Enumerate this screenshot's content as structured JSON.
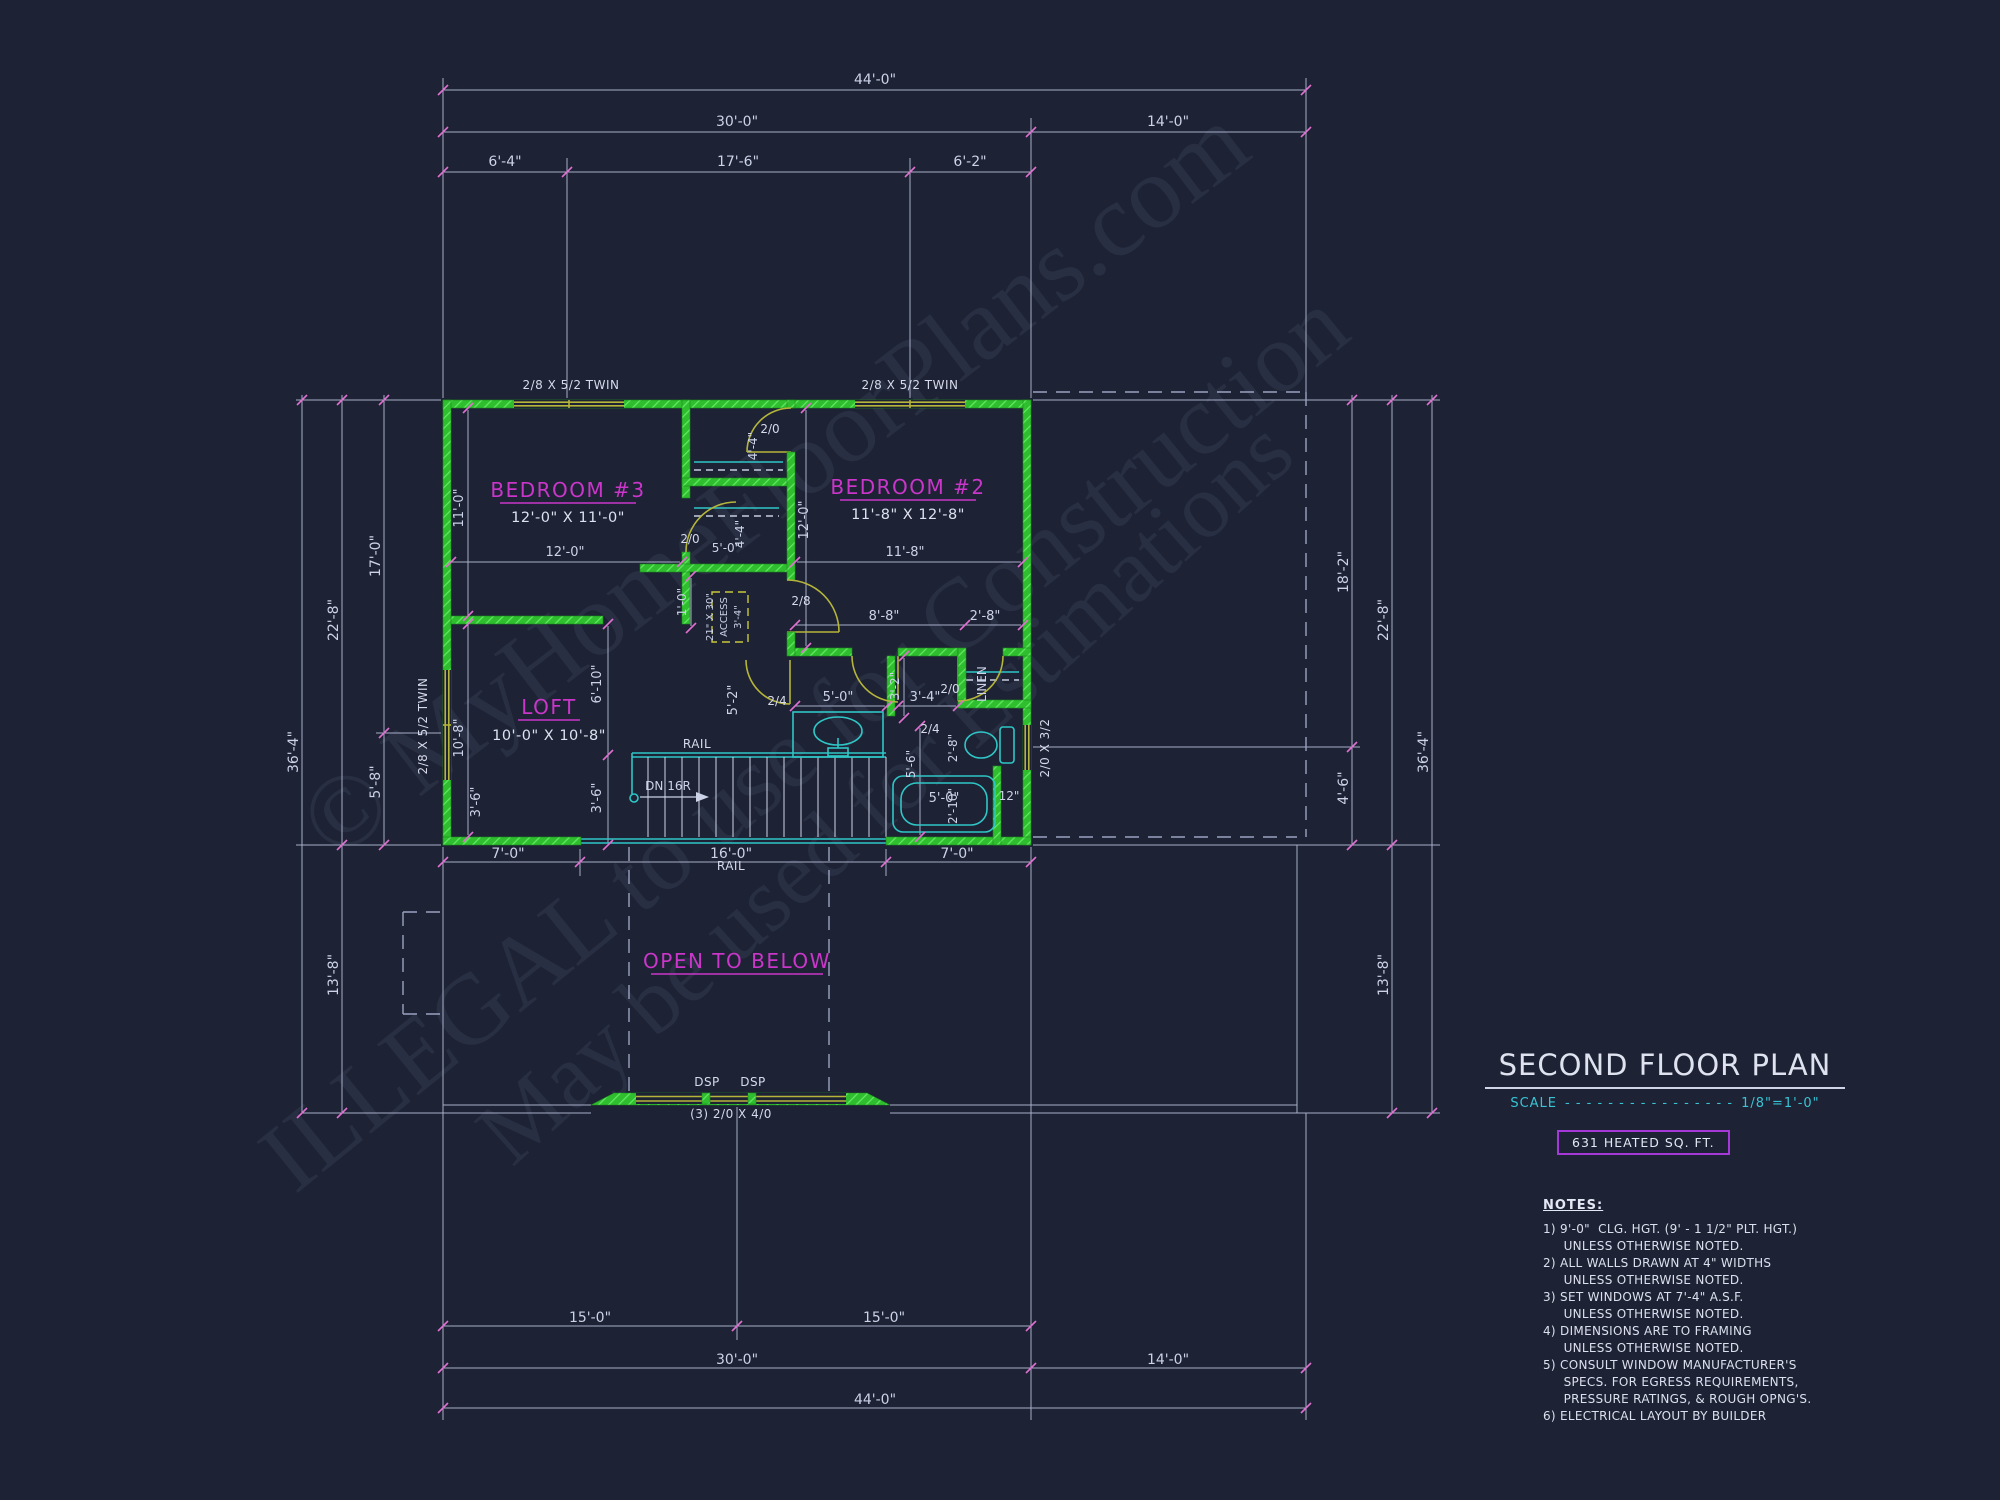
{
  "watermark": {
    "line1": "© MyHomeFloorPlans.com",
    "line2": "ILLEGAL to use for Construction",
    "line3": "May be used for Estimations"
  },
  "title_block": {
    "title": "SECOND FLOOR PLAN",
    "scale_label": "SCALE",
    "scale_dots": "- - - - - - - - - - - - - - - -",
    "scale_value": "1/8\"=1'-0\"",
    "heated_area": "631 HEATED SQ. FT.",
    "notes_heading": "NOTES:",
    "notes": [
      "1) 9'-0\"  CLG. HGT. (9' - 1 1/2\" PLT. HGT.)",
      "     UNLESS OTHERWISE NOTED.",
      "2) ALL WALLS DRAWN AT 4\" WIDTHS",
      "     UNLESS OTHERWISE NOTED.",
      "3) SET WINDOWS AT 7'-4\" A.S.F.",
      "     UNLESS OTHERWISE NOTED.",
      "4) DIMENSIONS ARE TO FRAMING",
      "     UNLESS OTHERWISE NOTED.",
      "5) CONSULT WINDOW MANUFACTURER'S",
      "     SPECS. FOR EGRESS REQUIREMENTS,",
      "     PRESSURE RATINGS, & ROUGH OPNG'S.",
      "6) ELECTRICAL LAYOUT BY BUILDER"
    ]
  },
  "rooms": {
    "bed3": {
      "name": "BEDROOM #3",
      "size": "12'-0\" X 11'-0\""
    },
    "bed2": {
      "name": "BEDROOM #2",
      "size": "11'-8\" X 12'-8\""
    },
    "loft": {
      "name": "LOFT",
      "size": "10'-0\" X 10'-8\""
    },
    "open_below": {
      "name": "OPEN TO BELOW"
    }
  },
  "colors": {
    "background": "#1d2234",
    "walls_green": "#2ebe2e",
    "room_label_magenta": "#c936c9",
    "dimension_text": "#ccd2e8",
    "cyan_accent": "#2fc6c6",
    "scale_cyan": "#38c4d4",
    "heated_box_purple": "#a438d8",
    "window_olive": "#b5b53a",
    "tick_pink": "#e070d0"
  },
  "plan_labels": [
    {
      "t": "44'-0\"",
      "x": 875,
      "y": 84
    },
    {
      "t": "30'-0\"",
      "x": 737,
      "y": 126
    },
    {
      "t": "14'-0\"",
      "x": 1168,
      "y": 126
    },
    {
      "t": "6'-4\"",
      "x": 505,
      "y": 166
    },
    {
      "t": "17'-6\"",
      "x": 738,
      "y": 166
    },
    {
      "t": "6'-2\"",
      "x": 970,
      "y": 166
    },
    {
      "t": "7'-0\"",
      "x": 508,
      "y": 858
    },
    {
      "t": "16'-0\"",
      "x": 731,
      "y": 858
    },
    {
      "t": "7'-0\"",
      "x": 957,
      "y": 858
    },
    {
      "t": "15'-0\"",
      "x": 590,
      "y": 1322
    },
    {
      "t": "15'-0\"",
      "x": 884,
      "y": 1322
    },
    {
      "t": "30'-0\"",
      "x": 737,
      "y": 1364
    },
    {
      "t": "14'-0\"",
      "x": 1168,
      "y": 1364
    },
    {
      "t": "44'-0\"",
      "x": 875,
      "y": 1404
    },
    {
      "t": "36'-4\"",
      "x": 298,
      "y": 752,
      "r": -90
    },
    {
      "t": "22'-8\"",
      "x": 338,
      "y": 620,
      "r": -90
    },
    {
      "t": "17'-0\"",
      "x": 380,
      "y": 556,
      "r": -90
    },
    {
      "t": "5'-8\"",
      "x": 380,
      "y": 782,
      "r": -90
    },
    {
      "t": "13'-8\"",
      "x": 338,
      "y": 975,
      "r": -90
    },
    {
      "t": "18'-2\"",
      "x": 1348,
      "y": 572,
      "r": -90
    },
    {
      "t": "4'-6\"",
      "x": 1348,
      "y": 788,
      "r": -90
    },
    {
      "t": "22'-8\"",
      "x": 1388,
      "y": 620,
      "r": -90
    },
    {
      "t": "36'-4\"",
      "x": 1428,
      "y": 752,
      "r": -90
    },
    {
      "t": "13'-8\"",
      "x": 1388,
      "y": 975,
      "r": -90
    },
    {
      "t": "12'-0\"",
      "x": 565,
      "y": 556,
      "fs": 13
    },
    {
      "t": "11'-8\"",
      "x": 905,
      "y": 556,
      "fs": 13
    },
    {
      "t": "11'-0\"",
      "x": 463,
      "y": 508,
      "r": -90,
      "fs": 13
    },
    {
      "t": "10'-8\"",
      "x": 463,
      "y": 738,
      "r": -90,
      "fs": 13
    },
    {
      "t": "6'-10\"",
      "x": 601,
      "y": 684,
      "r": -90,
      "fs": 13
    },
    {
      "t": "3'-6\"",
      "x": 601,
      "y": 798,
      "r": -90,
      "fs": 13
    },
    {
      "t": "3'-6\"",
      "x": 480,
      "y": 802,
      "r": -90,
      "fs": 13
    },
    {
      "t": "5'-2\"",
      "x": 737,
      "y": 700,
      "r": -90,
      "fs": 13
    },
    {
      "t": "4'-4\"",
      "x": 757,
      "y": 446,
      "r": -90,
      "fs": 12
    },
    {
      "t": "4'-4\"",
      "x": 744,
      "y": 534,
      "r": -90,
      "fs": 12
    },
    {
      "t": "5'-0\"",
      "x": 726,
      "y": 552,
      "fs": 12
    },
    {
      "t": "12'-0\"",
      "x": 808,
      "y": 520,
      "r": -90,
      "fs": 13
    },
    {
      "t": "1'-0\"",
      "x": 686,
      "y": 602,
      "r": -90,
      "fs": 12
    },
    {
      "t": "8'-8\"",
      "x": 884,
      "y": 620,
      "fs": 13
    },
    {
      "t": "2'-8\"",
      "x": 985,
      "y": 620,
      "fs": 13
    },
    {
      "t": "3'-2\"",
      "x": 899,
      "y": 686,
      "r": -90,
      "fs": 12
    },
    {
      "t": "3'-4\"",
      "x": 925,
      "y": 701,
      "fs": 13
    },
    {
      "t": "5'-0\"",
      "x": 838,
      "y": 701,
      "fs": 13
    },
    {
      "t": "5'-6\"",
      "x": 915,
      "y": 764,
      "r": -90,
      "fs": 12
    },
    {
      "t": "2'-8\"",
      "x": 957,
      "y": 748,
      "r": -90,
      "fs": 12
    },
    {
      "t": "2'-10\"",
      "x": 957,
      "y": 806,
      "r": -90,
      "fs": 12
    },
    {
      "t": "5'-0\"",
      "x": 944,
      "y": 802,
      "fs": 13
    },
    {
      "t": "12\"",
      "x": 1009,
      "y": 800,
      "fs": 12
    },
    {
      "t": "2/0",
      "x": 690,
      "y": 543,
      "c": "door"
    },
    {
      "t": "2/0",
      "x": 770,
      "y": 433,
      "c": "door"
    },
    {
      "t": "2/8",
      "x": 801,
      "y": 605,
      "c": "door"
    },
    {
      "t": "2/4",
      "x": 777,
      "y": 705,
      "c": "door"
    },
    {
      "t": "2/4",
      "x": 930,
      "y": 733,
      "c": "door"
    },
    {
      "t": "2/0",
      "x": 950,
      "y": 693,
      "c": "door"
    },
    {
      "t": "2/8 X 5/2 TWIN",
      "x": 571,
      "y": 389,
      "c": "win"
    },
    {
      "t": "2/8 X 5/2 TWIN",
      "x": 910,
      "y": 389,
      "c": "win"
    },
    {
      "t": "2/8 X 5/2 TWIN",
      "x": 427,
      "y": 726,
      "r": -90,
      "c": "win"
    },
    {
      "t": "2/0 X 3/2",
      "x": 1049,
      "y": 748,
      "r": -90,
      "c": "win"
    },
    {
      "t": "(3) 2/0 X 4/0",
      "x": 731,
      "y": 1118,
      "c": "win"
    },
    {
      "t": "DSP",
      "x": 707,
      "y": 1086,
      "c": "win"
    },
    {
      "t": "DSP",
      "x": 753,
      "y": 1086,
      "c": "win"
    },
    {
      "t": "RAIL",
      "x": 697,
      "y": 748,
      "c": "win"
    },
    {
      "t": "RAIL",
      "x": 731,
      "y": 870,
      "c": "win"
    },
    {
      "t": "DN 16R",
      "x": 668,
      "y": 790,
      "fs": 12
    },
    {
      "t": "LINEN",
      "x": 986,
      "y": 684,
      "r": -90,
      "fs": 12
    },
    {
      "t": "21\" X 30\"",
      "x": 713,
      "y": 617,
      "r": -90,
      "fs": 10
    },
    {
      "t": "ACCESS",
      "x": 727,
      "y": 617,
      "r": -90,
      "fs": 10
    },
    {
      "t": "3'-4\"",
      "x": 741,
      "y": 617,
      "r": -90,
      "fs": 10
    }
  ]
}
